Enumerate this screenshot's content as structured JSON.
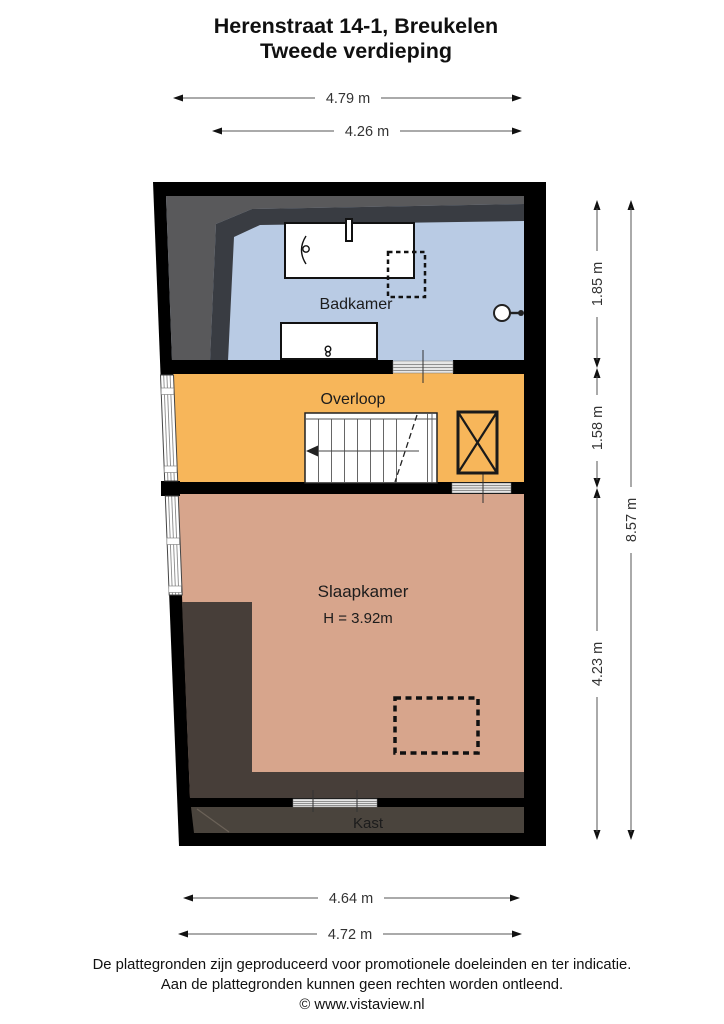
{
  "title": {
    "line1": "Herenstraat 14-1, Breukelen",
    "line2": "Tweede verdieping"
  },
  "floorplan": {
    "rooms": {
      "badkamer": {
        "label": "Badkamer"
      },
      "overloop": {
        "label": "Overloop"
      },
      "slaapkamer": {
        "label": "Slaapkamer",
        "height": "H = 3.92m"
      },
      "kast": {
        "label": "Kast"
      }
    },
    "dimensions": {
      "top_outer": "4.79 m",
      "top_inner": "4.26 m",
      "right_badkamer": "1.85 m",
      "right_overloop": "1.58 m",
      "right_slaapkamer": "4.23 m",
      "right_total": "8.57 m",
      "bottom_inner": "4.64 m",
      "bottom_outer": "4.72 m"
    }
  },
  "footer": {
    "line1": "De plattegronden zijn geproduceerd voor promotionele doeleinden en ter indicatie.",
    "line2": "Aan de plattegronden kunnen geen rechten worden ontleend.",
    "line3": "© www.vistaview.nl"
  },
  "colors": {
    "wall": "#000000",
    "badkamer_floor": "#b9cbe4",
    "overloop_floor": "#f7b65a",
    "slaapkamer_floor": "#d7a58c",
    "attic_zone": "#473e39",
    "kast_floor": "#4a443d",
    "roof_slope_light": "#59595b",
    "roof_slope_dark": "#393c42"
  }
}
